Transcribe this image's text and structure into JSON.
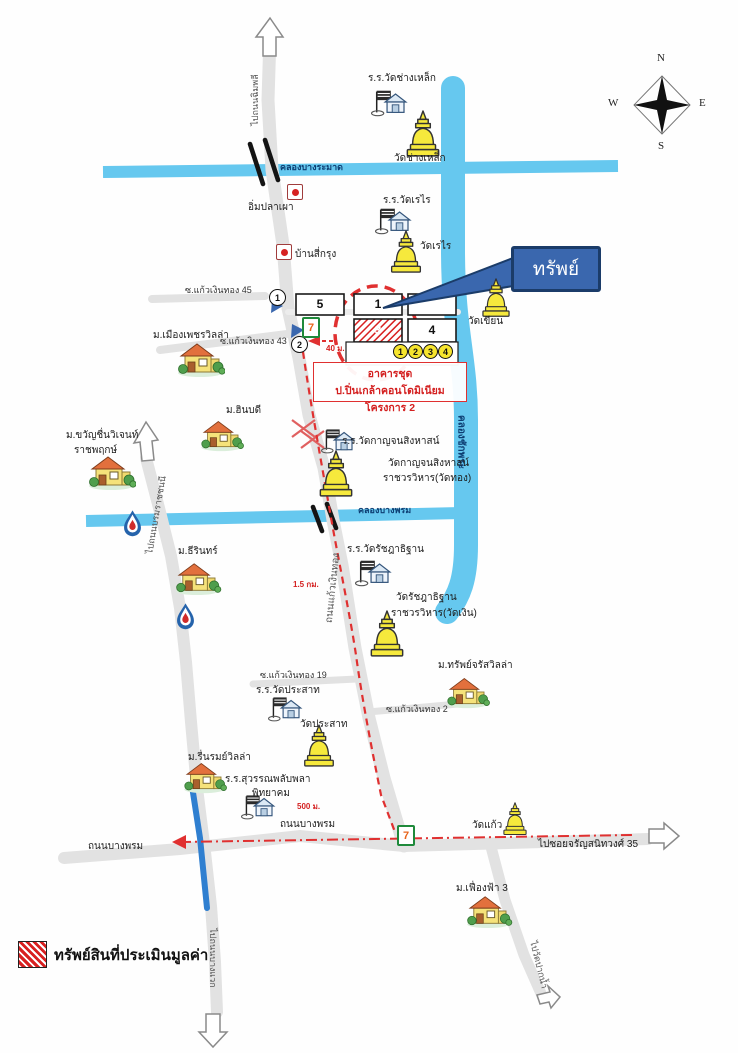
{
  "icons": {
    "seven_label": "7"
  },
  "compass": {
    "north": "N",
    "south": "S",
    "east": "E",
    "west": "W"
  },
  "callout": {
    "label": "ทรัพย์"
  },
  "legend": {
    "label": "ทรัพย์สินที่ประเมินมูลค่า"
  },
  "roads": {
    "to_chimphli": "ไปถนนฉิมพลี",
    "kaeo_ngoen_thong": "ถนนแก้วเงินทอง",
    "to_borommaratchachonnani": "ไปถนนบรมราชชนนี",
    "bang_phrom_left": "ถนนบางพรม",
    "bang_phrom_right": "ถนนบางพรม",
    "to_charansanitwong_35": "ไปซอยจรัญสนิทวงศ์ 35",
    "to_wat_paknam": "ไปวัดปากน้ำ",
    "to_bang_waek": "ไปถนนบางแวก",
    "soi_45": "ซ.แก้วเงินทอง 45",
    "soi_43": "ซ.แก้วเงินทอง 43",
    "soi_19": "ซ.แก้วเงินทอง 19",
    "soi_2": "ซ.แก้วเงินทอง 2"
  },
  "canals": {
    "bang_ramat": "คลองบางระมาด",
    "bang_phrom": "คลองบางพรม",
    "chak_phra": "คลองชักพระ"
  },
  "property": {
    "blocks": {
      "b5": "5",
      "b1": "1",
      "b3": "3",
      "b4": "4"
    },
    "unit_circles": [
      "1",
      "2",
      "3",
      "4"
    ],
    "route_points": [
      "1",
      "2"
    ],
    "note_line1": "อาคารชุด",
    "note_line2": "ป.ปิ่นเกล้าคอนโดมิเนียม โครงการ 2",
    "dist_40": "40 ม.",
    "dist_1_5": "1.5 กม.",
    "dist_500": "500 ม."
  },
  "places": {
    "school_changlek": "ร.ร.วัดช่างเหล็ก",
    "wat_changlek": "วัดช่างเหล็ก",
    "im_pla_phao": "อิ่มปลาเผา",
    "school_rerai": "ร.ร.วัดเรไร",
    "wat_rerai": "วัดเรไร",
    "ban_si_krung": "บ้านสี่กรุง",
    "mu_mueang_phet": "ม.เมืองเพชรวิลล่า",
    "wat_khian": "วัดเขียน",
    "mu_hinbodi": "ม.ฮินบดี",
    "school_kanchana": "ร.ร.วัดกาญจนสิงหาสน์",
    "wat_kanchana_1": "วัดกาญจนสิงหาสน์",
    "wat_kanchana_2": "ราชวรวิหาร(วัดทอง)",
    "mu_khwanchuen_1": "ม.ขวัญชื่นวิเจนท์",
    "mu_khwanchuen_2": "ราชพฤกษ์",
    "mu_thirin": "ม.ธีรินทร์",
    "school_ratchada": "ร.ร.วัดรัชฎาธิฐาน",
    "wat_ratchada_1": "วัดรัชฎาธิฐาน",
    "wat_ratchada_2": "ราชวรวิหาร(วัดเงิน)",
    "mu_sap_charat": "ม.ทรัพย์จรัสวิลล่า",
    "school_prasat": "ร.ร.วัดประสาท",
    "wat_prasat": "วัดประสาท",
    "mu_ruenrom": "ม.รื่นรมย์วิลล่า",
    "school_suwan_1": "ร.ร.สุวรรณพลับพลา",
    "school_suwan_2": "พิทยาคม",
    "wat_kaeo": "วัดแก้ว",
    "mu_fueangfa": "ม.เฟื่องฟ้า 3"
  },
  "colors": {
    "canal": "#66c8ef",
    "route_red": "#e03030",
    "callout_blue": "#3a67ae",
    "chedi_yellow": "#f6e93c"
  }
}
